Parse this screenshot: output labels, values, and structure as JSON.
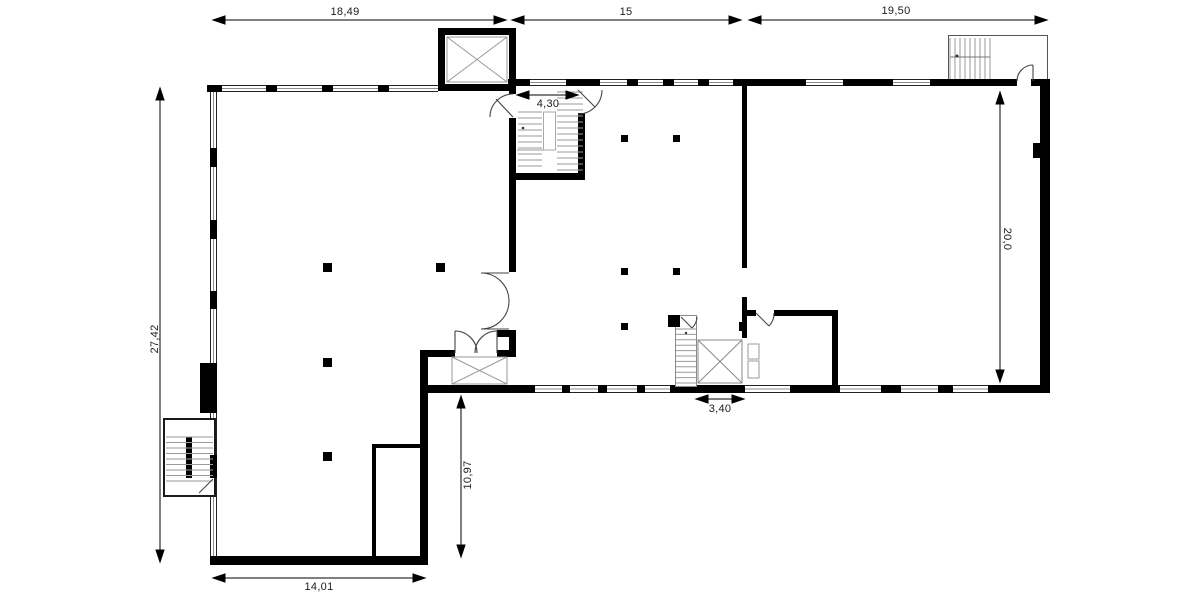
{
  "plan": {
    "dimensions": {
      "top_left": "18,49",
      "top_mid": "15",
      "top_right": "19,50",
      "left": "27,42",
      "right": "20,0",
      "entry": "4,30",
      "core": "3,40",
      "annex_h": "10,97",
      "annex_w": "14,01"
    },
    "colors": {
      "wall": "#000000",
      "thin_line": "#444444",
      "stair_line": "#9a9a9a"
    }
  }
}
